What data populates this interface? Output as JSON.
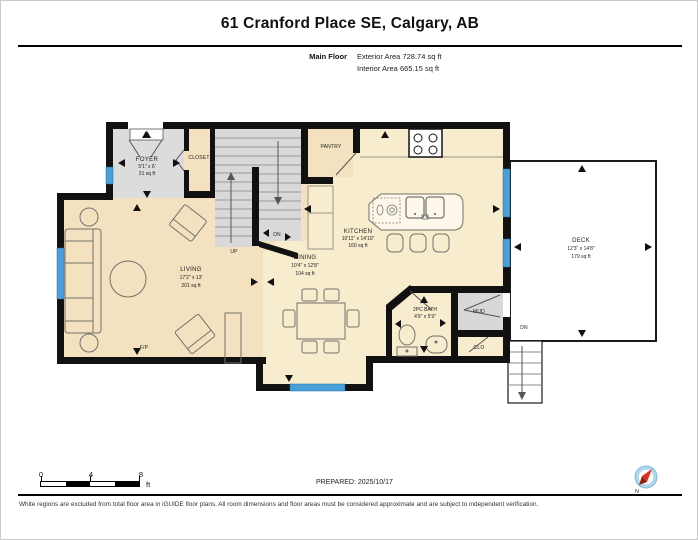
{
  "header": {
    "title": "61 Cranford Place SE, Calgary, AB",
    "floor_label": "Main Floor",
    "exterior_area": "Exterior Area 728.74 sq ft",
    "interior_area": "Interior Area 665.15 sq ft"
  },
  "rooms": {
    "foyer": {
      "name": "FOYER",
      "dims": "5'1\" x 6'",
      "area": "31 sq ft"
    },
    "closet": {
      "name": "CLOSET"
    },
    "pantry": {
      "name": "PANTRY"
    },
    "kitchen": {
      "name": "KITCHEN",
      "dims": "10'11\" x 14'10\"",
      "area": "160 sq ft"
    },
    "living": {
      "name": "LIVING",
      "dims": "17'2\" x 13'",
      "area": "201 sq ft"
    },
    "dining": {
      "name": "DINING",
      "dims": "10'4\" x 12'8\"",
      "area": "104 sq ft"
    },
    "bath": {
      "name": "2PC BATH",
      "dims": "4'9\" x 5'9\""
    },
    "mud": {
      "name": "MUD"
    },
    "clo": {
      "name": "CLO"
    },
    "deck": {
      "name": "DECK",
      "dims": "12'3\" x 14'8\"",
      "area": "179 sq ft"
    }
  },
  "plan_annotations": {
    "up": "UP",
    "dn_stairs": "DN",
    "dn_deck": "DN",
    "fireplace": "F/P"
  },
  "scale_bar": {
    "tick_0": "0",
    "tick_4": "4",
    "tick_8": "8",
    "unit": "ft"
  },
  "footer": {
    "prepared": "PREPARED: 2025/10/17",
    "disclaimer": "White regions are excluded from total floor area in iGUIDE floor plans. All room dimensions and floor areas must be considered approximate and are subject to independent verification.",
    "compass_north": "N"
  },
  "colors": {
    "floor_main": "#f3e1c0",
    "floor_light": "#f8ecce",
    "floor_gray": "#dcdcdc",
    "wall": "#111111",
    "window_blue": "#4aa0d6"
  }
}
